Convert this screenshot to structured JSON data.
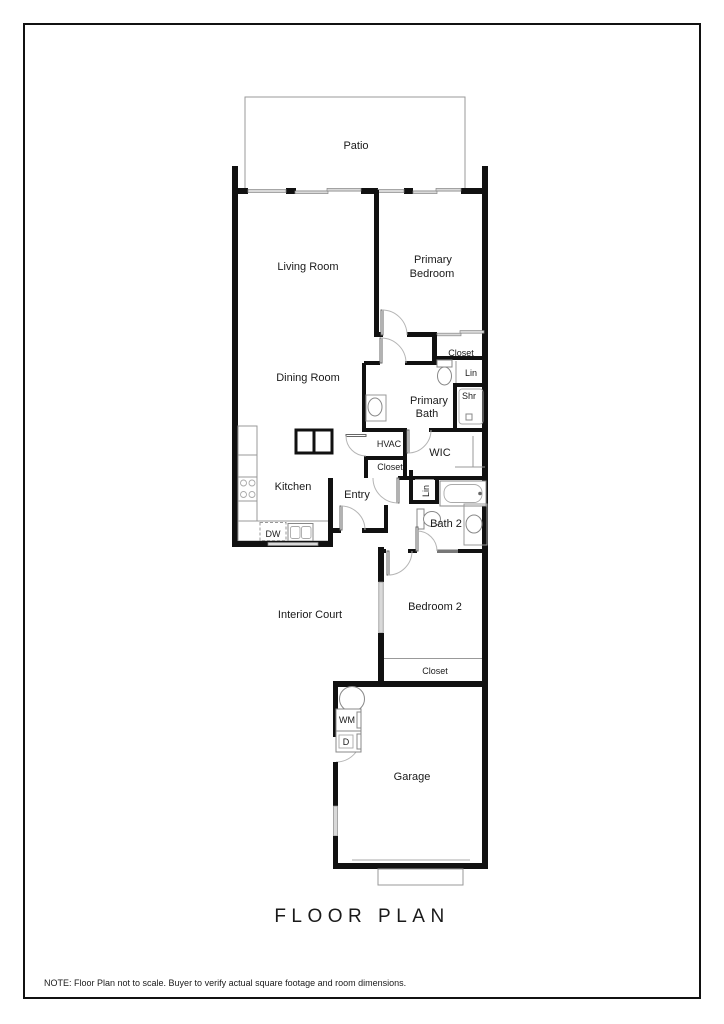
{
  "page": {
    "title": "FLOOR PLAN",
    "note": "NOTE: Floor Plan not to scale. Buyer to verify actual square footage and room dimensions."
  },
  "rooms": {
    "patio": "Patio",
    "living_room": "Living Room",
    "primary_bedroom_line1": "Primary",
    "primary_bedroom_line2": "Bedroom",
    "dining_room": "Dining Room",
    "primary_closet": "Closet",
    "linen_primary": "Lin",
    "primary_bath_line1": "Primary",
    "primary_bath_line2": "Bath",
    "shower": "Shr",
    "hvac": "HVAC",
    "wic": "WIC",
    "hall_closet": "Closet",
    "kitchen": "Kitchen",
    "entry": "Entry",
    "linen_bath2": "Lin",
    "bath2": "Bath 2",
    "dishwasher": "DW",
    "interior_court": "Interior Court",
    "bedroom2": "Bedroom 2",
    "bedroom2_closet": "Closet",
    "washer": "WM",
    "dryer": "D",
    "garage": "Garage"
  },
  "fixtures": [
    "toilet-icon",
    "sink-icon",
    "bathtub-icon",
    "shower-icon",
    "stove-icon",
    "kitchen-sink-icon",
    "dishwasher-icon",
    "washer-icon",
    "dryer-icon",
    "water-heater-icon",
    "garage-door-icon",
    "door-swing-icon",
    "window-icon",
    "sliding-door-icon"
  ],
  "colors": {
    "wall": "#111111",
    "thin_line": "#999999",
    "window_fill": "#d9d9d9",
    "text": "#1a1a1a",
    "background": "#ffffff"
  }
}
